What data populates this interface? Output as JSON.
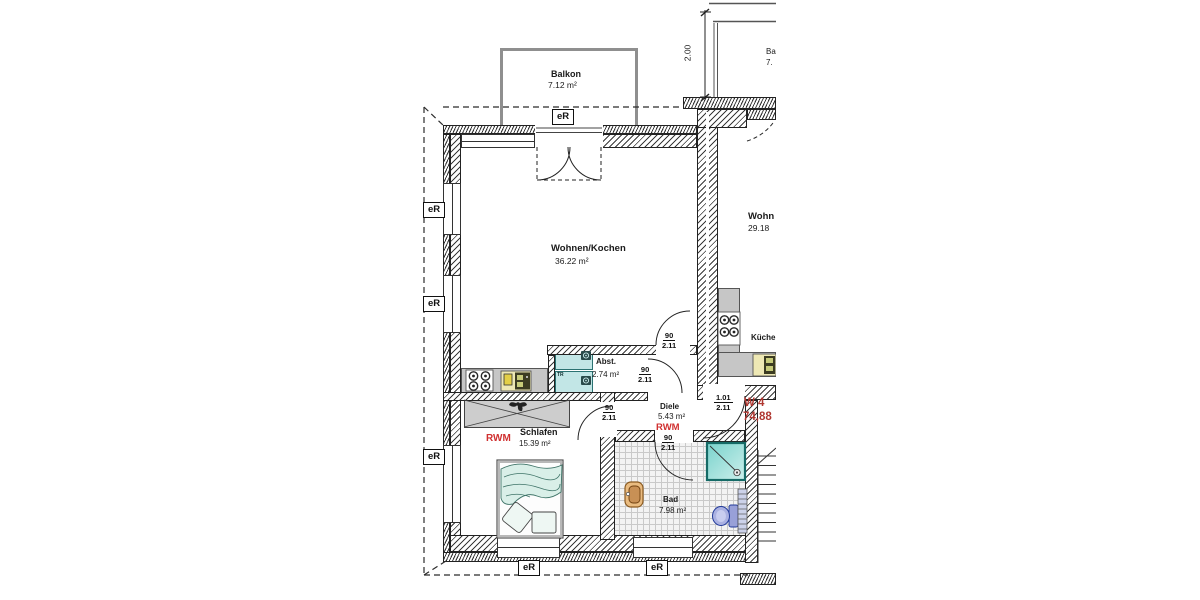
{
  "colors": {
    "wall_line": "#222222",
    "accent_red": "#d03030",
    "apartment_red": "#b03832",
    "counter_gray": "#c6c6c6",
    "appliance_cyan": "#c2e6e6",
    "shower_cyan": "#79d2cc",
    "basin_tan": "#e9bb80",
    "toilet_blue": "#aab1e2",
    "bed_mint": "#d9efe8",
    "balcony_gray": "#8f8f8f"
  },
  "plan": {
    "apartment": {
      "id": "W 4",
      "area": "74,88"
    },
    "shutter_label": "eR",
    "smoke_detector_label": "RWM",
    "balcony_depth_dim": "2.00",
    "rooms": {
      "balcony": {
        "name": "Balkon",
        "area": "7.12 m²"
      },
      "living_kitchen": {
        "name": "Wohnen/Kochen",
        "area": "36.22 m²"
      },
      "storage": {
        "name": "Abst.",
        "area": "2.74 m²"
      },
      "hall": {
        "name": "Diele",
        "area": "5.43 m²"
      },
      "bedroom": {
        "name": "Schlafen",
        "area": "15.39 m²"
      },
      "bath": {
        "name": "Bad",
        "area": "7.98 m²"
      }
    },
    "neighbor": {
      "living": {
        "name": "Wohn",
        "area": "29.18"
      },
      "kitchen": {
        "name": "Küche"
      },
      "balcony": {
        "name": "Ba",
        "area": "7."
      }
    },
    "appliances": {
      "washer": "WM",
      "dryer": "TR"
    },
    "door_dims": [
      {
        "w": "90",
        "h": "2.11"
      },
      {
        "w": "90",
        "h": "2.11"
      },
      {
        "w": "90",
        "h": "2.11"
      },
      {
        "w": "90",
        "h": "2.11"
      },
      {
        "w": "1.01",
        "h": "2.11"
      }
    ]
  }
}
